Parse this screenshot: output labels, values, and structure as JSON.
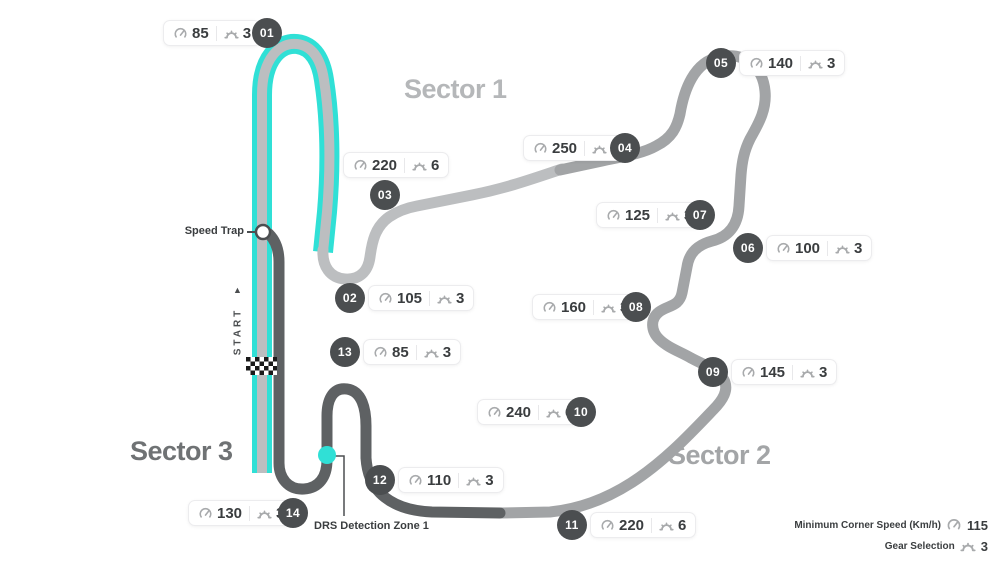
{
  "sectors": [
    {
      "label": "Sector 1"
    },
    {
      "label": "Sector 2"
    },
    {
      "label": "Sector 3"
    }
  ],
  "corners": [
    {
      "number": "01",
      "speed": "85",
      "gear": "3",
      "badge": {
        "x": 267,
        "y": 33
      },
      "pill": {
        "x": 163,
        "y": 20
      }
    },
    {
      "number": "02",
      "speed": "105",
      "gear": "3",
      "badge": {
        "x": 350,
        "y": 298
      },
      "pill": {
        "x": 368,
        "y": 285
      }
    },
    {
      "number": "03",
      "speed": "220",
      "gear": "6",
      "badge": {
        "x": 385,
        "y": 195
      },
      "pill": {
        "x": 343,
        "y": 152
      }
    },
    {
      "number": "04",
      "speed": "250",
      "gear": "7",
      "badge": {
        "x": 625,
        "y": 148
      },
      "pill": {
        "x": 523,
        "y": 135
      }
    },
    {
      "number": "05",
      "speed": "140",
      "gear": "3",
      "badge": {
        "x": 721,
        "y": 63
      },
      "pill": {
        "x": 739,
        "y": 50
      }
    },
    {
      "number": "06",
      "speed": "100",
      "gear": "3",
      "badge": {
        "x": 748,
        "y": 248
      },
      "pill": {
        "x": 766,
        "y": 235
      }
    },
    {
      "number": "07",
      "speed": "125",
      "gear": "3",
      "badge": {
        "x": 700,
        "y": 215
      },
      "pill": {
        "x": 596,
        "y": 202
      }
    },
    {
      "number": "08",
      "speed": "160",
      "gear": "3",
      "badge": {
        "x": 636,
        "y": 307
      },
      "pill": {
        "x": 532,
        "y": 294
      }
    },
    {
      "number": "09",
      "speed": "145",
      "gear": "3",
      "badge": {
        "x": 713,
        "y": 372
      },
      "pill": {
        "x": 731,
        "y": 359
      }
    },
    {
      "number": "10",
      "speed": "240",
      "gear": "6",
      "badge": {
        "x": 581,
        "y": 412
      },
      "pill": {
        "x": 477,
        "y": 399
      }
    },
    {
      "number": "11",
      "speed": "220",
      "gear": "6",
      "badge": {
        "x": 572,
        "y": 525
      },
      "pill": {
        "x": 590,
        "y": 512
      }
    },
    {
      "number": "12",
      "speed": "110",
      "gear": "3",
      "badge": {
        "x": 380,
        "y": 480
      },
      "pill": {
        "x": 398,
        "y": 467
      }
    },
    {
      "number": "13",
      "speed": "85",
      "gear": "3",
      "badge": {
        "x": 345,
        "y": 352
      },
      "pill": {
        "x": 363,
        "y": 339
      }
    },
    {
      "number": "14",
      "speed": "130",
      "gear": "3",
      "badge": {
        "x": 293,
        "y": 513
      },
      "pill": {
        "x": 188,
        "y": 500
      }
    }
  ],
  "annotations": {
    "speed_trap_label": "Speed Trap",
    "start_label": "START",
    "start_arrow": "▲",
    "drs_label": "DRS Detection Zone 1"
  },
  "legend": {
    "rows": [
      {
        "label": "Minimum Corner Speed (Km/h)",
        "icon": "speedometer-icon",
        "value": "115"
      },
      {
        "label": "Gear Selection",
        "icon": "gear-icon",
        "value": "3"
      }
    ]
  },
  "colors": {
    "sector1_track": "#bcbec0",
    "sector2_track": "#a2a4a6",
    "sector3_track": "#5e6163",
    "drs_zone": "#30e0d6",
    "corner_badge": "#4b4e50",
    "pill_text": "#3a3d3f"
  }
}
